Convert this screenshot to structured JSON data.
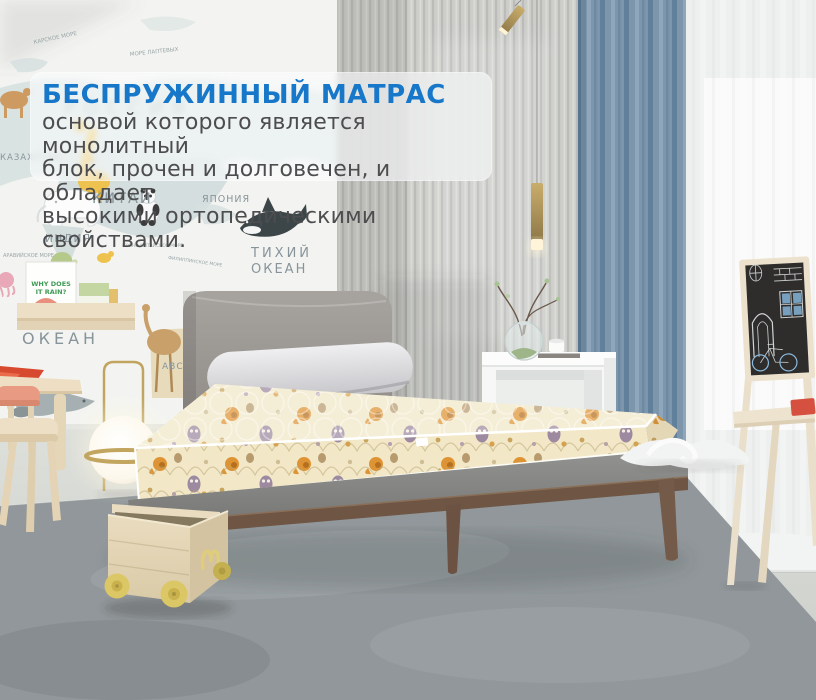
{
  "overlay": {
    "title": "БЕСПРУЖИННЫЙ МАТРАС",
    "body": "основой которого является монолитный\nблок, прочен и долговечен, и обладает\nвысокими ортопедическими свойствами."
  },
  "map_labels": {
    "russia": "РОССИЯ",
    "kara_sea": "КАРСКОЕ МОРЕ",
    "laptev_sea": "МОРЕ ЛАПТЕВЫХ",
    "kazakhstan": "КАЗАХСТАН",
    "china": "КИТАЙ",
    "japan": "ЯПОНИЯ",
    "india": "ИНДИЯ",
    "arabian_sea": "АРАВИЙСКОЕ МОРЕ",
    "south_china_sea": "ЮЖНО-КИТАЙСКОЕ МОРЕ",
    "philippine_sea": "ФИЛИППИНСКОЕ МОРЕ",
    "pacific_word1": "ТИХИЙ",
    "pacific_word2": "ОКЕАН",
    "indian_ocean_word": "ОКЕАН",
    "australia": "АВСТРАЛИЯ"
  },
  "shelf_book": {
    "title_line1": "WHY DOES",
    "title_line2": "IT RAIN?"
  },
  "colors": {
    "accent_title_blue": "#1777c9",
    "body_text_gray": "#4d4d4f",
    "mattress_cream": "#f2e8c8",
    "curtain_blue": "#7d96ac"
  }
}
